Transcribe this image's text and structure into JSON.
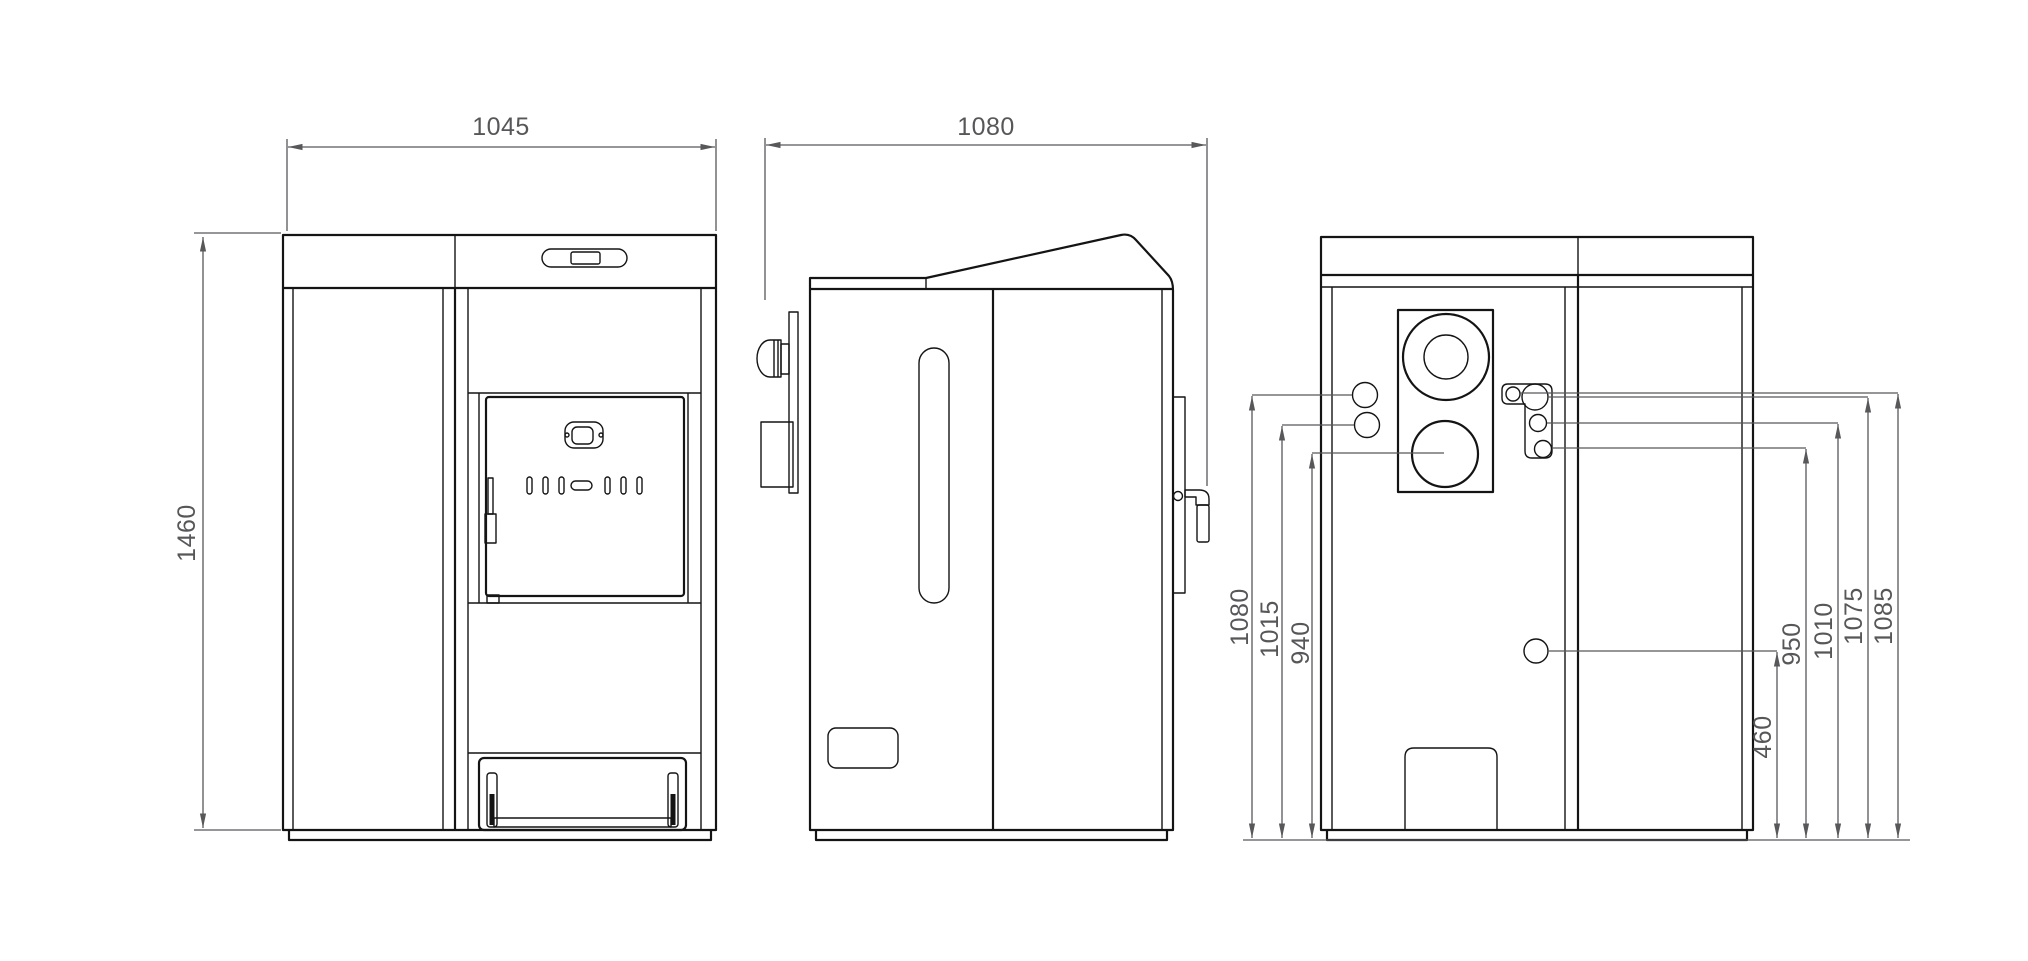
{
  "views": {
    "front": {
      "width_mm": "1045",
      "height_mm": "1460"
    },
    "side": {
      "depth_mm": "1080"
    },
    "rear": {
      "left_heights": [
        "1080",
        "1015",
        "940"
      ],
      "right_heights": [
        "460",
        "950",
        "1010",
        "1075",
        "1085"
      ]
    }
  },
  "colors": {
    "object_line": "#141414",
    "dimension": "#58585a",
    "background": "#ffffff"
  }
}
